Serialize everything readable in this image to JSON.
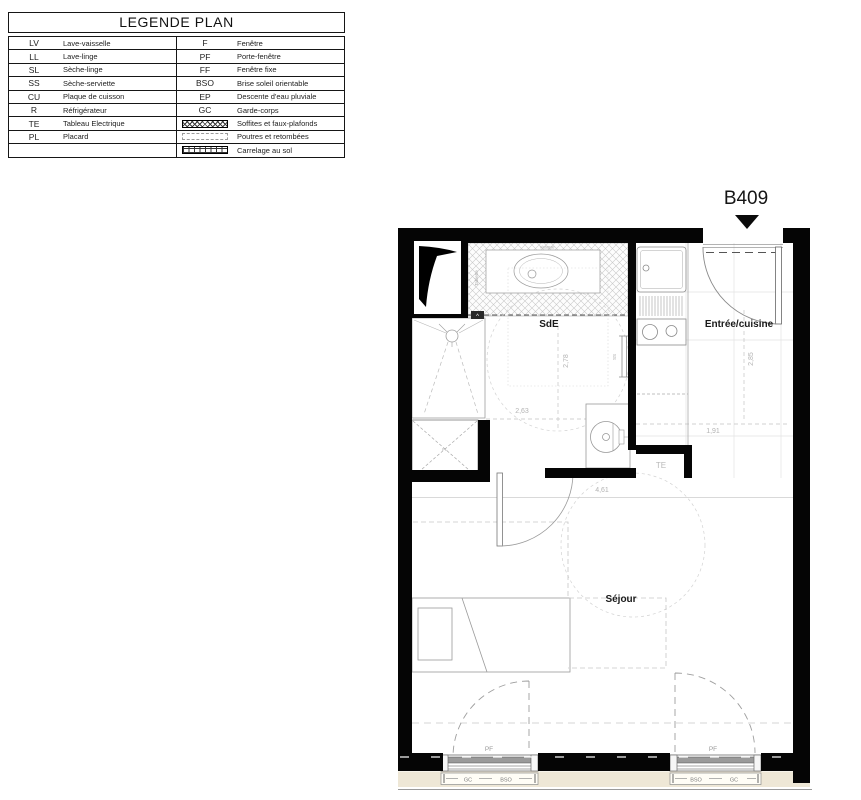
{
  "legend": {
    "title": "LEGENDE PLAN",
    "rows": [
      {
        "la": "LV",
        "ld": "Lave-vaisselle",
        "ra": "F",
        "rd": "Fenêtre"
      },
      {
        "la": "LL",
        "ld": "Lave-linge",
        "ra": "PF",
        "rd": "Porte-fenêtre"
      },
      {
        "la": "SL",
        "ld": "Sèche-linge",
        "ra": "FF",
        "rd": "Fenêtre fixe"
      },
      {
        "la": "SS",
        "ld": "Sèche-serviette",
        "ra": "BSO",
        "rd": "Brise soleil orientable"
      },
      {
        "la": "CU",
        "ld": "Plaque de cuisson",
        "ra": "EP",
        "rd": "Descente d'eau pluviale"
      },
      {
        "la": "R",
        "ld": "Réfrigérateur",
        "ra": "GC",
        "rd": "Garde-corps"
      },
      {
        "la": "TE",
        "ld": "Tableau Electrique",
        "swatch": "hatch",
        "rd": "Soffites et faux-plafonds"
      },
      {
        "la": "PL",
        "ld": "Placard",
        "swatch": "dashed",
        "rd": "Poutres et retombées"
      },
      {
        "la": "",
        "ld": "",
        "swatch": "grid",
        "rd": "Carrelage au sol"
      }
    ]
  },
  "plan": {
    "unit": "B409",
    "rooms": {
      "sde": "SdE",
      "entree": "Entrée/cuisine",
      "sejour": "Séjour"
    },
    "dims": {
      "sde_w": "2,63",
      "sde_h": "2,78",
      "kitchen_h": "2,85",
      "kitchen_w": "1,91",
      "sejour_w": "4,61"
    },
    "labels": {
      "te": "TE",
      "pf": "PF",
      "gc": "GC",
      "bso": "BSO",
      "tablette": "Tablette",
      "vasque": "Vasque",
      "ss": "SS",
      "pl": "PL",
      "caret": "^"
    }
  }
}
